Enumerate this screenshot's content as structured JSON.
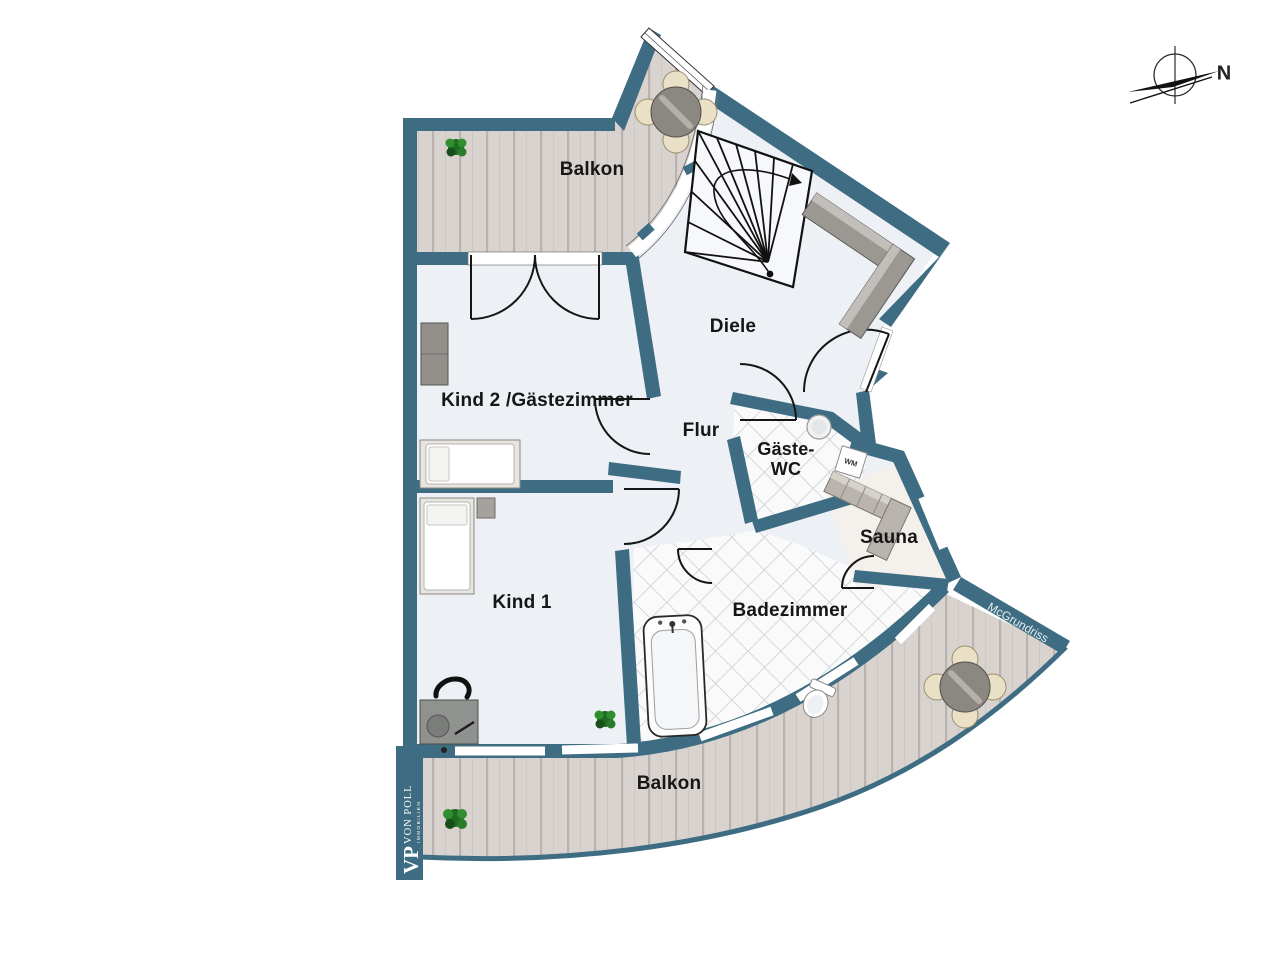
{
  "meta": {
    "type": "floor-plan",
    "language": "de"
  },
  "colors": {
    "wall": "#3E6C82",
    "interior_floor": "#EDF0F5",
    "deck": "#D9D3D0",
    "deck_line": "#BAB2AF",
    "tile_bg": "#FAFAFA",
    "tile_line": "#C7CCD4",
    "outline": "#161616",
    "furniture_gray": "#9B9893",
    "chair_beige": "#E9E0C6"
  },
  "rooms": [
    {
      "id": "balkon-top",
      "label": "Balkon"
    },
    {
      "id": "diele",
      "label": "Diele"
    },
    {
      "id": "kind2-gaestezimmer",
      "label": "Kind 2 /Gästezimmer"
    },
    {
      "id": "flur",
      "label": "Flur"
    },
    {
      "id": "gaeste-wc",
      "label_line1": "Gäste-",
      "label_line2": "WC"
    },
    {
      "id": "sauna",
      "label": "Sauna"
    },
    {
      "id": "kind1",
      "label": "Kind 1"
    },
    {
      "id": "badezimmer",
      "label": "Badezimmer"
    },
    {
      "id": "balkon-bottom",
      "label": "Balkon"
    }
  ],
  "annotations": {
    "north": "N",
    "washing_machine": "WM",
    "watermark": "McGrundriss"
  },
  "branding": {
    "logo_initials": "VP",
    "logo_name": "VON POLL",
    "logo_sub": "IMMOBILIEN"
  },
  "icons": [
    "north-compass-icon",
    "staircase",
    "sideboard",
    "wardrobe",
    "bed",
    "desk",
    "desk-chair",
    "plant-icon",
    "dining-table",
    "dining-chair",
    "bathtub",
    "toilet",
    "sink",
    "washing-machine",
    "sauna-bench",
    "entrance-arrow",
    "door-swing",
    "window",
    "railing"
  ]
}
